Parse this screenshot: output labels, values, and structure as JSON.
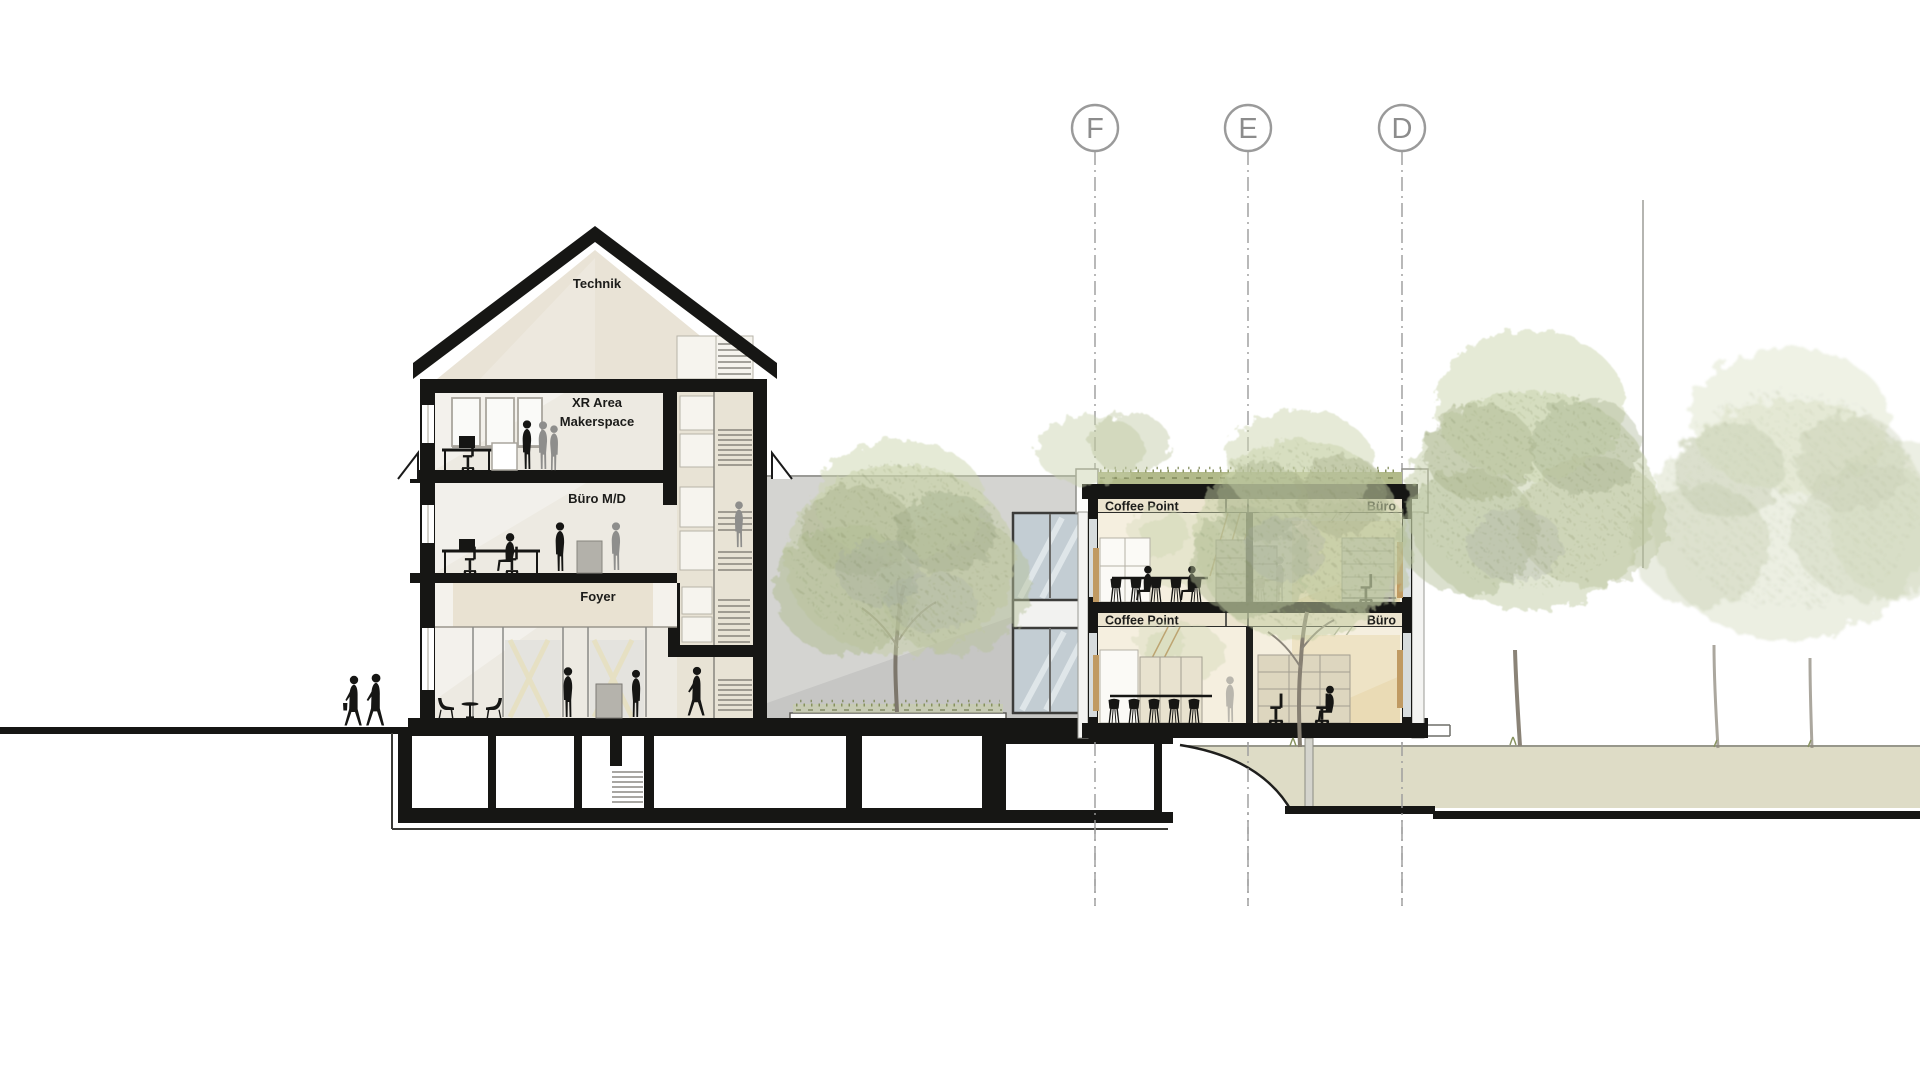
{
  "drawing": {
    "type": "architectural cross-section",
    "grid_axes": {
      "items": [
        {
          "id": "F"
        },
        {
          "id": "E"
        },
        {
          "id": "D"
        }
      ]
    },
    "left_building": {
      "attic_label": "Technik",
      "floor3_label_line1": "XR Area",
      "floor3_label_line2": "Makerspace",
      "floor2_label": "Büro M/D",
      "floor1_label": "Foyer"
    },
    "right_building": {
      "upper_left_label": "Coffee Point",
      "upper_right_label": "Büro",
      "lower_left_label": "Coffee Point",
      "lower_right_label": "Büro"
    },
    "palette": {
      "paper": "#ffffff",
      "ink": "#161614",
      "attic_beige": "#e9e3d6",
      "interior_beige": "#edeae2",
      "label_band_beige": "#ece4cf",
      "right_interior_beige": "#f5efdf",
      "tan_wall": "#eadbb5",
      "courtyard_wall_grey": "#c6c6c4",
      "glass_blue_grey": "#c3cdd3",
      "ground_beige": "#dedcc6",
      "green_roof": "#b2ba8a",
      "foliage_light": "#ccd5ae",
      "foliage_mid": "#b2bd94",
      "foliage_sage": "#a0aa84",
      "grid_grey": "#9b9b9b"
    }
  }
}
